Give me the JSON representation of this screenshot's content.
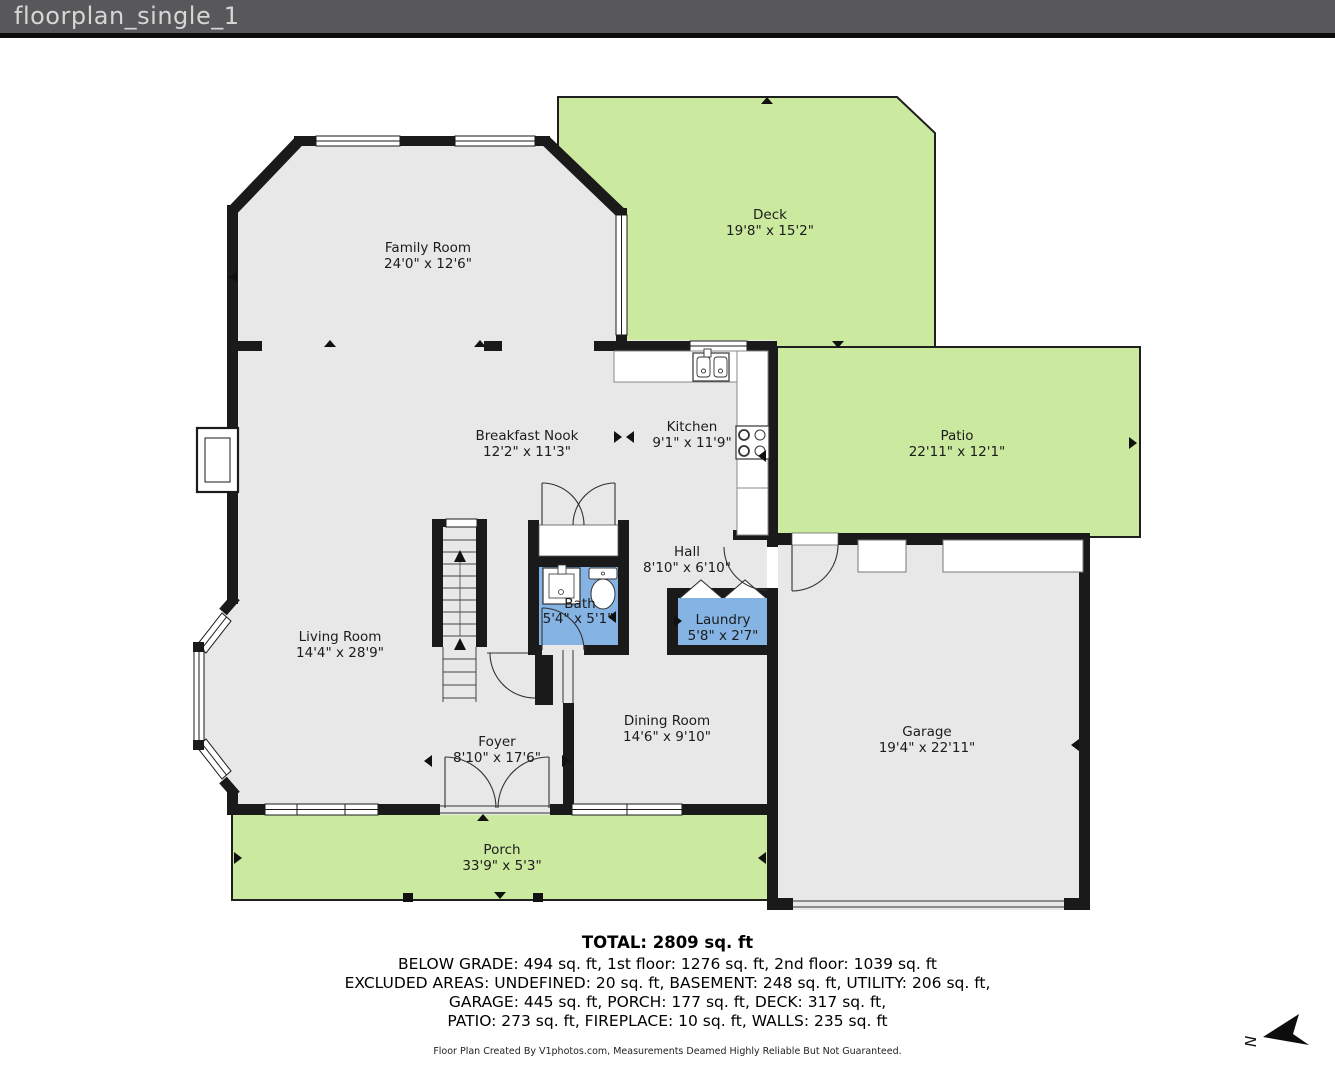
{
  "header": {
    "title": "floorplan_single_1"
  },
  "rooms": [
    {
      "id": "family-room",
      "name": "Family Room",
      "dims": "24'0\" x 12'6\""
    },
    {
      "id": "deck",
      "name": "Deck",
      "dims": "19'8\" x 15'2\""
    },
    {
      "id": "breakfast-nook",
      "name": "Breakfast Nook",
      "dims": "12'2\" x 11'3\""
    },
    {
      "id": "kitchen",
      "name": "Kitchen",
      "dims": "9'1\" x 11'9\""
    },
    {
      "id": "patio",
      "name": "Patio",
      "dims": "22'11\" x 12'1\""
    },
    {
      "id": "hall",
      "name": "Hall",
      "dims": "8'10\" x 6'10\""
    },
    {
      "id": "bath",
      "name": "Bath",
      "dims": "5'4\" x 5'1\""
    },
    {
      "id": "laundry",
      "name": "Laundry",
      "dims": "5'8\" x 2'7\""
    },
    {
      "id": "living-room",
      "name": "Living Room",
      "dims": "14'4\" x 28'9\""
    },
    {
      "id": "dining-room",
      "name": "Dining Room",
      "dims": "14'6\" x 9'10\""
    },
    {
      "id": "garage",
      "name": "Garage",
      "dims": "19'4\" x 22'11\""
    },
    {
      "id": "foyer",
      "name": "Foyer",
      "dims": "8'10\" x 17'6\""
    },
    {
      "id": "porch",
      "name": "Porch",
      "dims": "33'9\" x 5'3\""
    }
  ],
  "summary": {
    "total": "TOTAL: 2809 sq. ft",
    "line1": "BELOW GRADE: 494 sq. ft, 1st floor: 1276 sq. ft, 2nd floor: 1039 sq. ft",
    "line2": "EXCLUDED AREAS: UNDEFINED: 20 sq. ft, BASEMENT: 248 sq. ft, UTILITY: 206 sq. ft,",
    "line3": "GARAGE: 445 sq. ft, PORCH: 177 sq. ft, DECK: 317 sq. ft,",
    "line4": "PATIO: 273 sq. ft, FIREPLACE: 10 sq. ft, WALLS: 235 sq. ft"
  },
  "footer": {
    "credit": "Floor Plan Created By V1photos.com, Measurements Deamed Highly Reliable But Not Guaranteed."
  },
  "compass": {
    "label": "N"
  },
  "colors": {
    "outdoor_green": "#cbeaa0",
    "wet_room_blue": "#84b3e4",
    "room_gray": "#e8e8e8",
    "wall_black": "#1a1a1a",
    "header_gray": "#58585a"
  }
}
